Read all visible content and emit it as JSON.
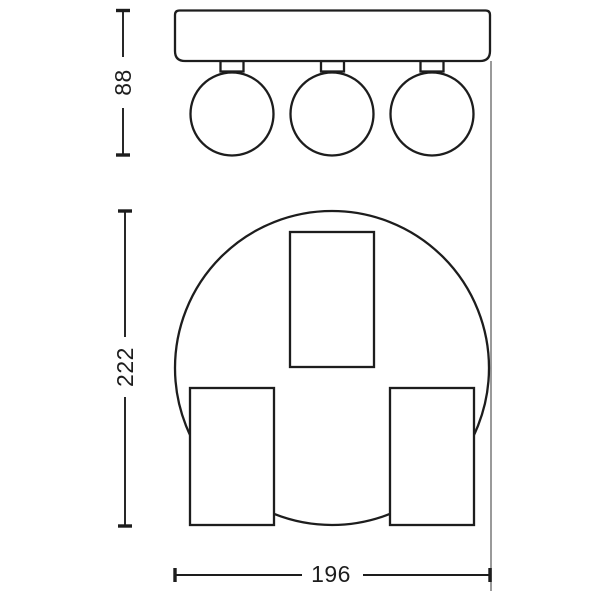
{
  "drawing": {
    "kind": "luminaire-dimension-drawing",
    "dimensions": {
      "head_height": {
        "label": "88",
        "orientation": "vertical"
      },
      "overall_length": {
        "label": "222",
        "orientation": "vertical"
      },
      "overall_width": {
        "label": "196",
        "orientation": "horizontal"
      }
    },
    "colors": {
      "line": "#1d1d1d",
      "projection_line": "#9a9a9a",
      "background": "#ffffff"
    }
  }
}
